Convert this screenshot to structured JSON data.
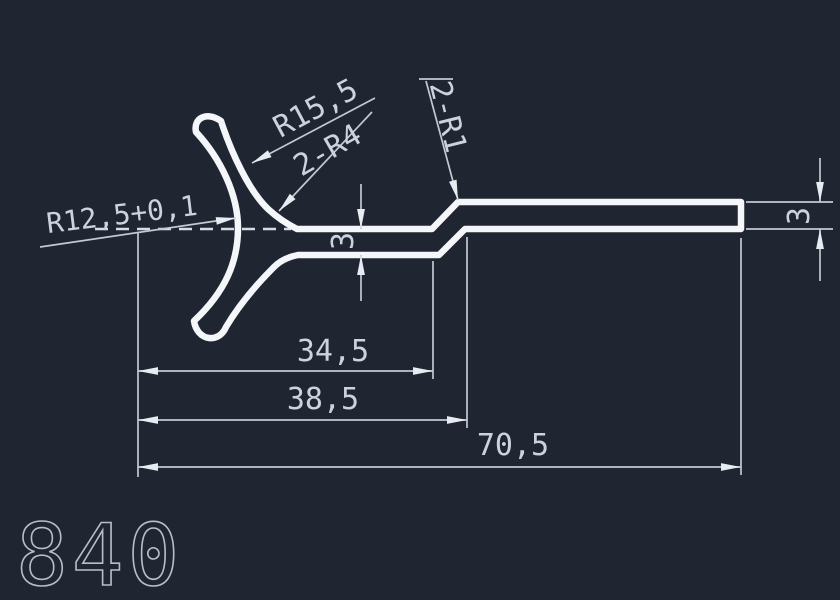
{
  "drawing": {
    "part_number": "840",
    "leaders": {
      "r15": "R15,5",
      "r4": "2-R4",
      "r1": "2-R1",
      "r12": "R12,5+0,1"
    },
    "dimensions": {
      "thickness_left": "3",
      "thickness_right": "3",
      "len_inner": "34,5",
      "len_middle": "38,5",
      "len_overall": "70,5"
    },
    "colors": {
      "background": "#202631",
      "geometry": "#f4f6f9",
      "dimension": "#c2c9d4"
    }
  }
}
